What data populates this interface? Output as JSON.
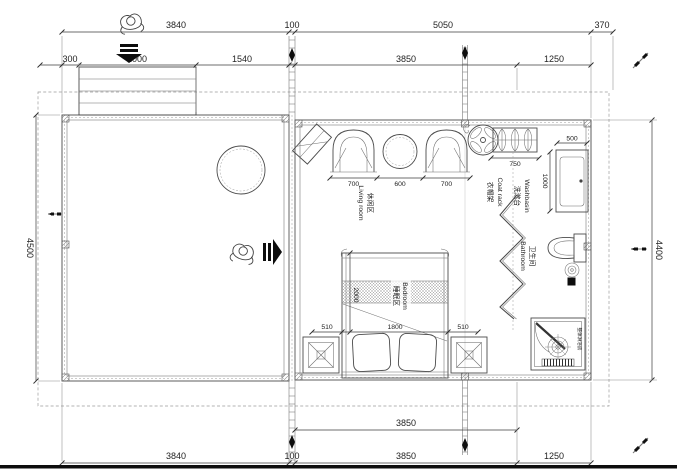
{
  "drawing": {
    "type": "architectural floor plan",
    "units": "mm"
  },
  "colors": {
    "line": "#4b4b4b",
    "light_line": "#8c8c8c",
    "text": "#232323",
    "black": "#0d0d0d",
    "background": "#ffffff"
  },
  "dims": {
    "top1": [
      "3840",
      "100",
      "5050",
      "370"
    ],
    "top2": [
      "300",
      "2000",
      "1540",
      "3850",
      "1250"
    ],
    "bottom1": [
      "3850"
    ],
    "bottom2": [
      "3840",
      "100",
      "3850",
      "1250"
    ],
    "left": "4500",
    "right": "4400",
    "living": [
      "700",
      "600",
      "700"
    ],
    "coat_rack": "750",
    "washbasin_width": "500",
    "washbasin_depth": "1000",
    "bed": {
      "left": "510",
      "width": "1800",
      "right": "510",
      "depth": "2000"
    }
  },
  "rooms": {
    "living": {
      "zh": "休闲区",
      "en": "Living room"
    },
    "bedroom": {
      "zh": "睡眠区",
      "en": "Bedroom"
    },
    "bathroom": {
      "zh": "卫生间",
      "en": "Bathroom"
    },
    "coat_rack": {
      "zh": "衣帽架",
      "en": "Coat rack"
    },
    "washbasin": {
      "zh": "洗漱台",
      "en": "Washbasin"
    },
    "shower": {
      "zh": "整体淋浴房"
    }
  },
  "icons": {
    "person": "top-view person figure",
    "entry_arrow": "solid black entry arrow",
    "pen": "marker pen glyph",
    "fan": "fan",
    "hanger": "clothes hanger",
    "continuation_marker": "black diamond grid marker"
  }
}
